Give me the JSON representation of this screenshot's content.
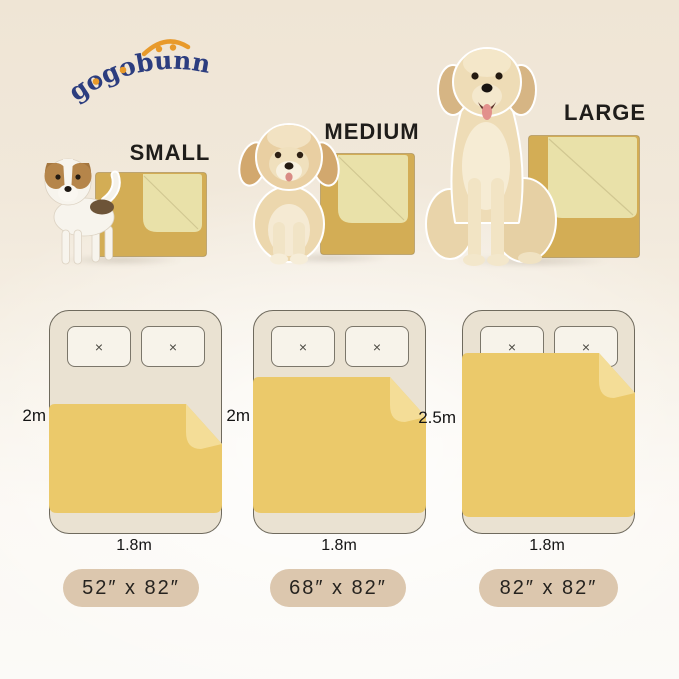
{
  "brand": {
    "logo_text": "gogobunny"
  },
  "sizes": [
    {
      "name": "SMALL",
      "badge_label": "52″ x 82″",
      "bed_length": "2m",
      "bed_width": "1.8m"
    },
    {
      "name": "MEDIUM",
      "badge_label": "68″ x 82″",
      "bed_length": "2m",
      "bed_width": "1.8m"
    },
    {
      "name": "LARGE",
      "badge_label": "82″ x 82″",
      "bed_length": "2.5m",
      "bed_width": "1.8m"
    }
  ],
  "icons": {
    "pillow_cross": "×"
  },
  "colors": {
    "logo_navy": "#2c3d7f",
    "logo_orange": "#e89a2b",
    "product_blanket": "#d3ad55",
    "product_blanket_fold": "#e9e1a9",
    "diagram_blanket": "#ebc96a",
    "diagram_blanket_fold": "#f4dd97",
    "bed_fill": "#eae2d2",
    "badge_bg": "#dcc7ae",
    "background_top": "#efe5d5",
    "background_bottom": "#fbfaf7"
  }
}
